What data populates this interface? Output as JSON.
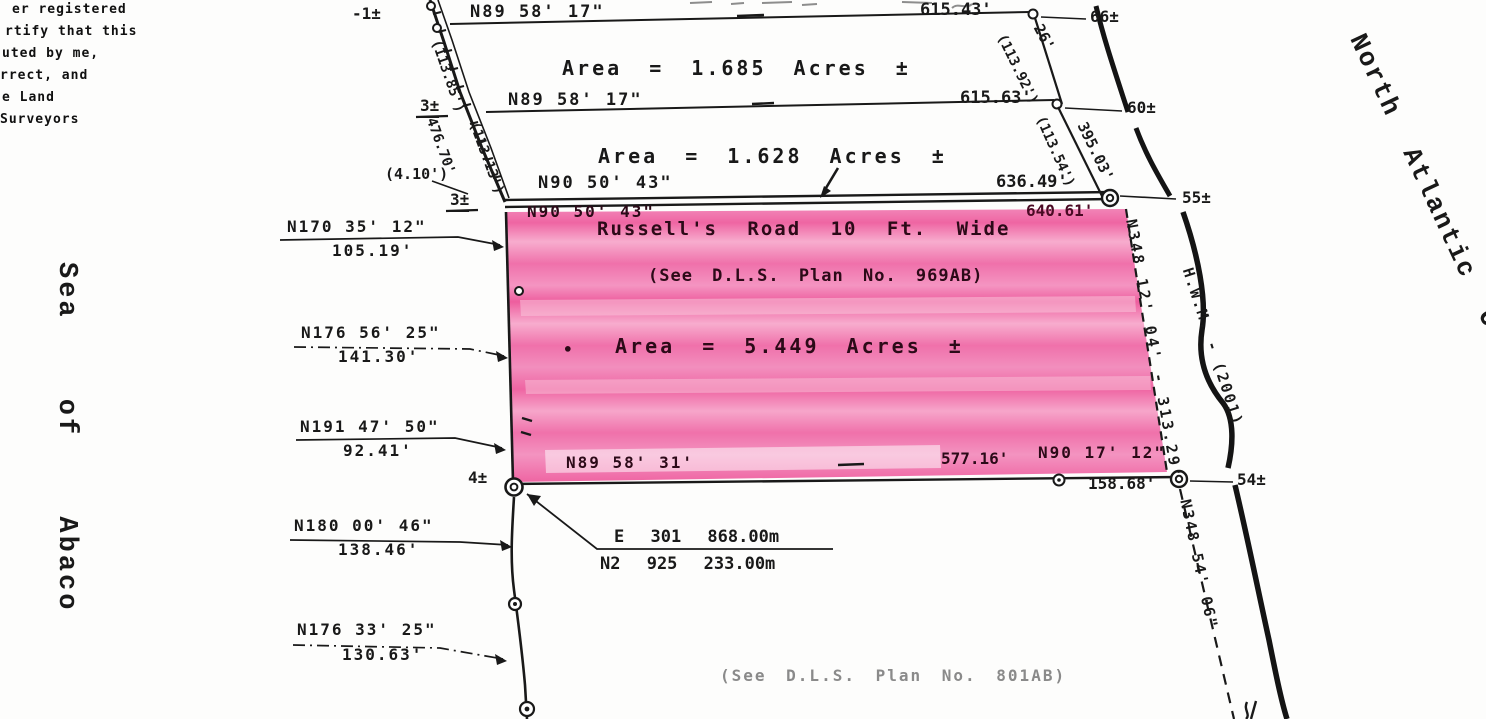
{
  "cert_note": {
    "lines": [
      "er registered",
      "rtify that this",
      "uted by me,",
      "rrect, and",
      "e Land",
      "Surveyors"
    ]
  },
  "margin": {
    "sea": "Sea of Abaco",
    "ocean": "North Atlantic O"
  },
  "upper_parcels": {
    "row1": {
      "left_tick": "-1±",
      "bearing": "N89 58' 17\"",
      "distance": "615.43'",
      "right_tick": "66±"
    },
    "parcel1_area": "Area = 1.685 Acres ±",
    "row2": {
      "left_tick": "3±",
      "bearing": "N89 58' 17\"",
      "distance": "615.63'",
      "right_tick": "60±"
    },
    "parcel2_area": "Area = 1.628 Acres ±",
    "row3": {
      "left_note": "(4.10')",
      "left_tick": "3±",
      "bearing": "N90 50' 43\"",
      "distance": "636.49'",
      "right_tick": "55±"
    }
  },
  "pink_parcel": {
    "road_bearing": "N90 50' 43\"",
    "road_distance": "640.61'",
    "road_name": "Russell's Road 10 Ft. Wide",
    "plan_ref": "(See D.L.S. Plan No. 969AB)",
    "area_bullet": "•",
    "area": "Area = 5.449 Acres ±",
    "south_bearing": "N89 58' 31'",
    "south_distance": "577.16'",
    "south_bearing_2": "N90 17' 12\"",
    "south_distance_2": "158.68'",
    "south_right_tick": "54±",
    "west_tick": "4±",
    "east_bearing_distance": "N348 12' 04' - 313.29'"
  },
  "slant_labels": {
    "nw_paren": "(113.85')",
    "w_distance": "476.70'",
    "w_paren": "(113.13')",
    "e1": "26'",
    "e1_paren": "(113.92')",
    "e2": "395.03'",
    "e2_paren": "(113.54')"
  },
  "west_shore_calls": [
    {
      "bearing": "N170 35' 12\"",
      "distance": "105.19'"
    },
    {
      "bearing": "N176 56' 25\"",
      "distance": "141.30'"
    },
    {
      "bearing": "N191 47' 50\"",
      "distance": "92.41'"
    },
    {
      "bearing": "N180 00' 46\"",
      "distance": "138.46'"
    },
    {
      "bearing": "N176 33' 25\"",
      "distance": "130.63'"
    }
  ],
  "benchmark": {
    "easting": "E 301 868.00m",
    "northing": "N2 925 233.00m"
  },
  "shore": {
    "hwm_label": "H.W.M. - (2001)",
    "se_bearing": "N348 54' 06\""
  },
  "footer_ref": "(See D.L.S. Plan No. 801AB)",
  "colors": {
    "highlight_pink": "#ee5f9f",
    "highlight_pink_light": "#f7a9cc",
    "ink": "#191919",
    "faded_ink": "#8a8a8a"
  }
}
